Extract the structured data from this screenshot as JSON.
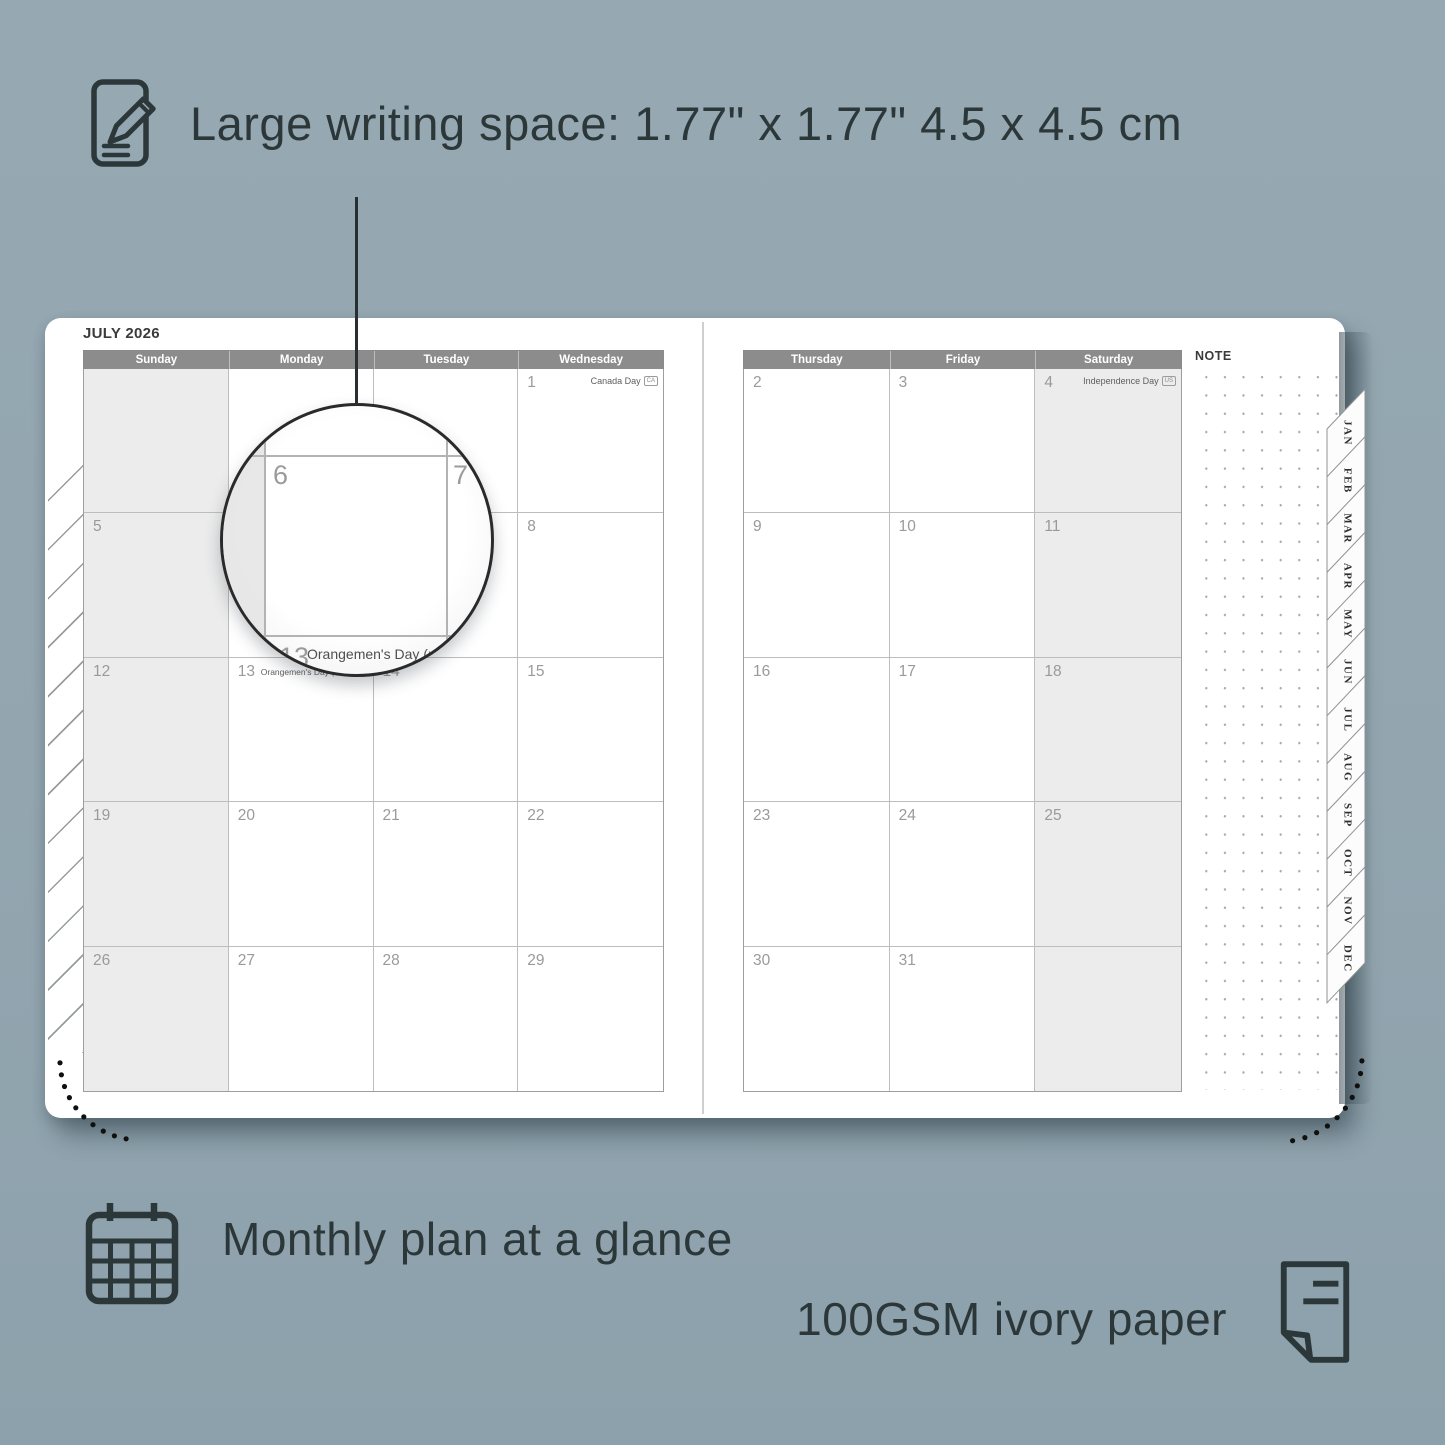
{
  "colors": {
    "background": "#93a6b1",
    "ink": "#2c3739",
    "header_band": "#8c8c8c",
    "weekend_cell": "#ececec",
    "grid_line": "#bdbdbd",
    "date_number": "#9a9a9a",
    "page": "#ffffff"
  },
  "annotations": {
    "writing_space": "Large writing space: 1.77\" x 1.77\" 4.5 x 4.5 cm",
    "monthly_plan": "Monthly plan at a glance",
    "paper": "100GSM ivory paper"
  },
  "planner": {
    "title": "JULY 2026",
    "note_label": "NOTE",
    "left_day_headers": [
      "Sunday",
      "Monday",
      "Tuesday",
      "Wednesday"
    ],
    "right_day_headers": [
      "Thursday",
      "Friday",
      "Saturday"
    ],
    "left_cells": [
      {
        "day": ""
      },
      {
        "day": ""
      },
      {
        "day": ""
      },
      {
        "day": "1",
        "event": "Canada Day",
        "badge": "CA",
        "event_align": "right"
      },
      {
        "day": "5"
      },
      {
        "day": "6"
      },
      {
        "day": "7"
      },
      {
        "day": "8"
      },
      {
        "day": "12"
      },
      {
        "day": "13",
        "event": "Orangemen's Day (n.i.)",
        "badge": "UK",
        "event_align": "left"
      },
      {
        "day": "14"
      },
      {
        "day": "15"
      },
      {
        "day": "19"
      },
      {
        "day": "20"
      },
      {
        "day": "21"
      },
      {
        "day": "22"
      },
      {
        "day": "26"
      },
      {
        "day": "27"
      },
      {
        "day": "28"
      },
      {
        "day": "29"
      }
    ],
    "right_cells": [
      {
        "day": "2"
      },
      {
        "day": "3"
      },
      {
        "day": "4",
        "event": "Independence Day",
        "badge": "US",
        "event_align": "right"
      },
      {
        "day": "9"
      },
      {
        "day": "10"
      },
      {
        "day": "11"
      },
      {
        "day": "16"
      },
      {
        "day": "17"
      },
      {
        "day": "18"
      },
      {
        "day": "23"
      },
      {
        "day": "24"
      },
      {
        "day": "25"
      },
      {
        "day": "30"
      },
      {
        "day": "31"
      },
      {
        "day": ""
      }
    ],
    "month_tabs": [
      "JAN",
      "FEB",
      "MAR",
      "APR",
      "MAY",
      "JUN",
      "JUL",
      "AUG",
      "SEP",
      "OCT",
      "NOV",
      "DEC"
    ],
    "magnifier": {
      "day": "6",
      "adjacent_day": "7",
      "event_day": "13",
      "event": "Orangemen's Day (n.i.)",
      "event_badge": "UK"
    }
  }
}
